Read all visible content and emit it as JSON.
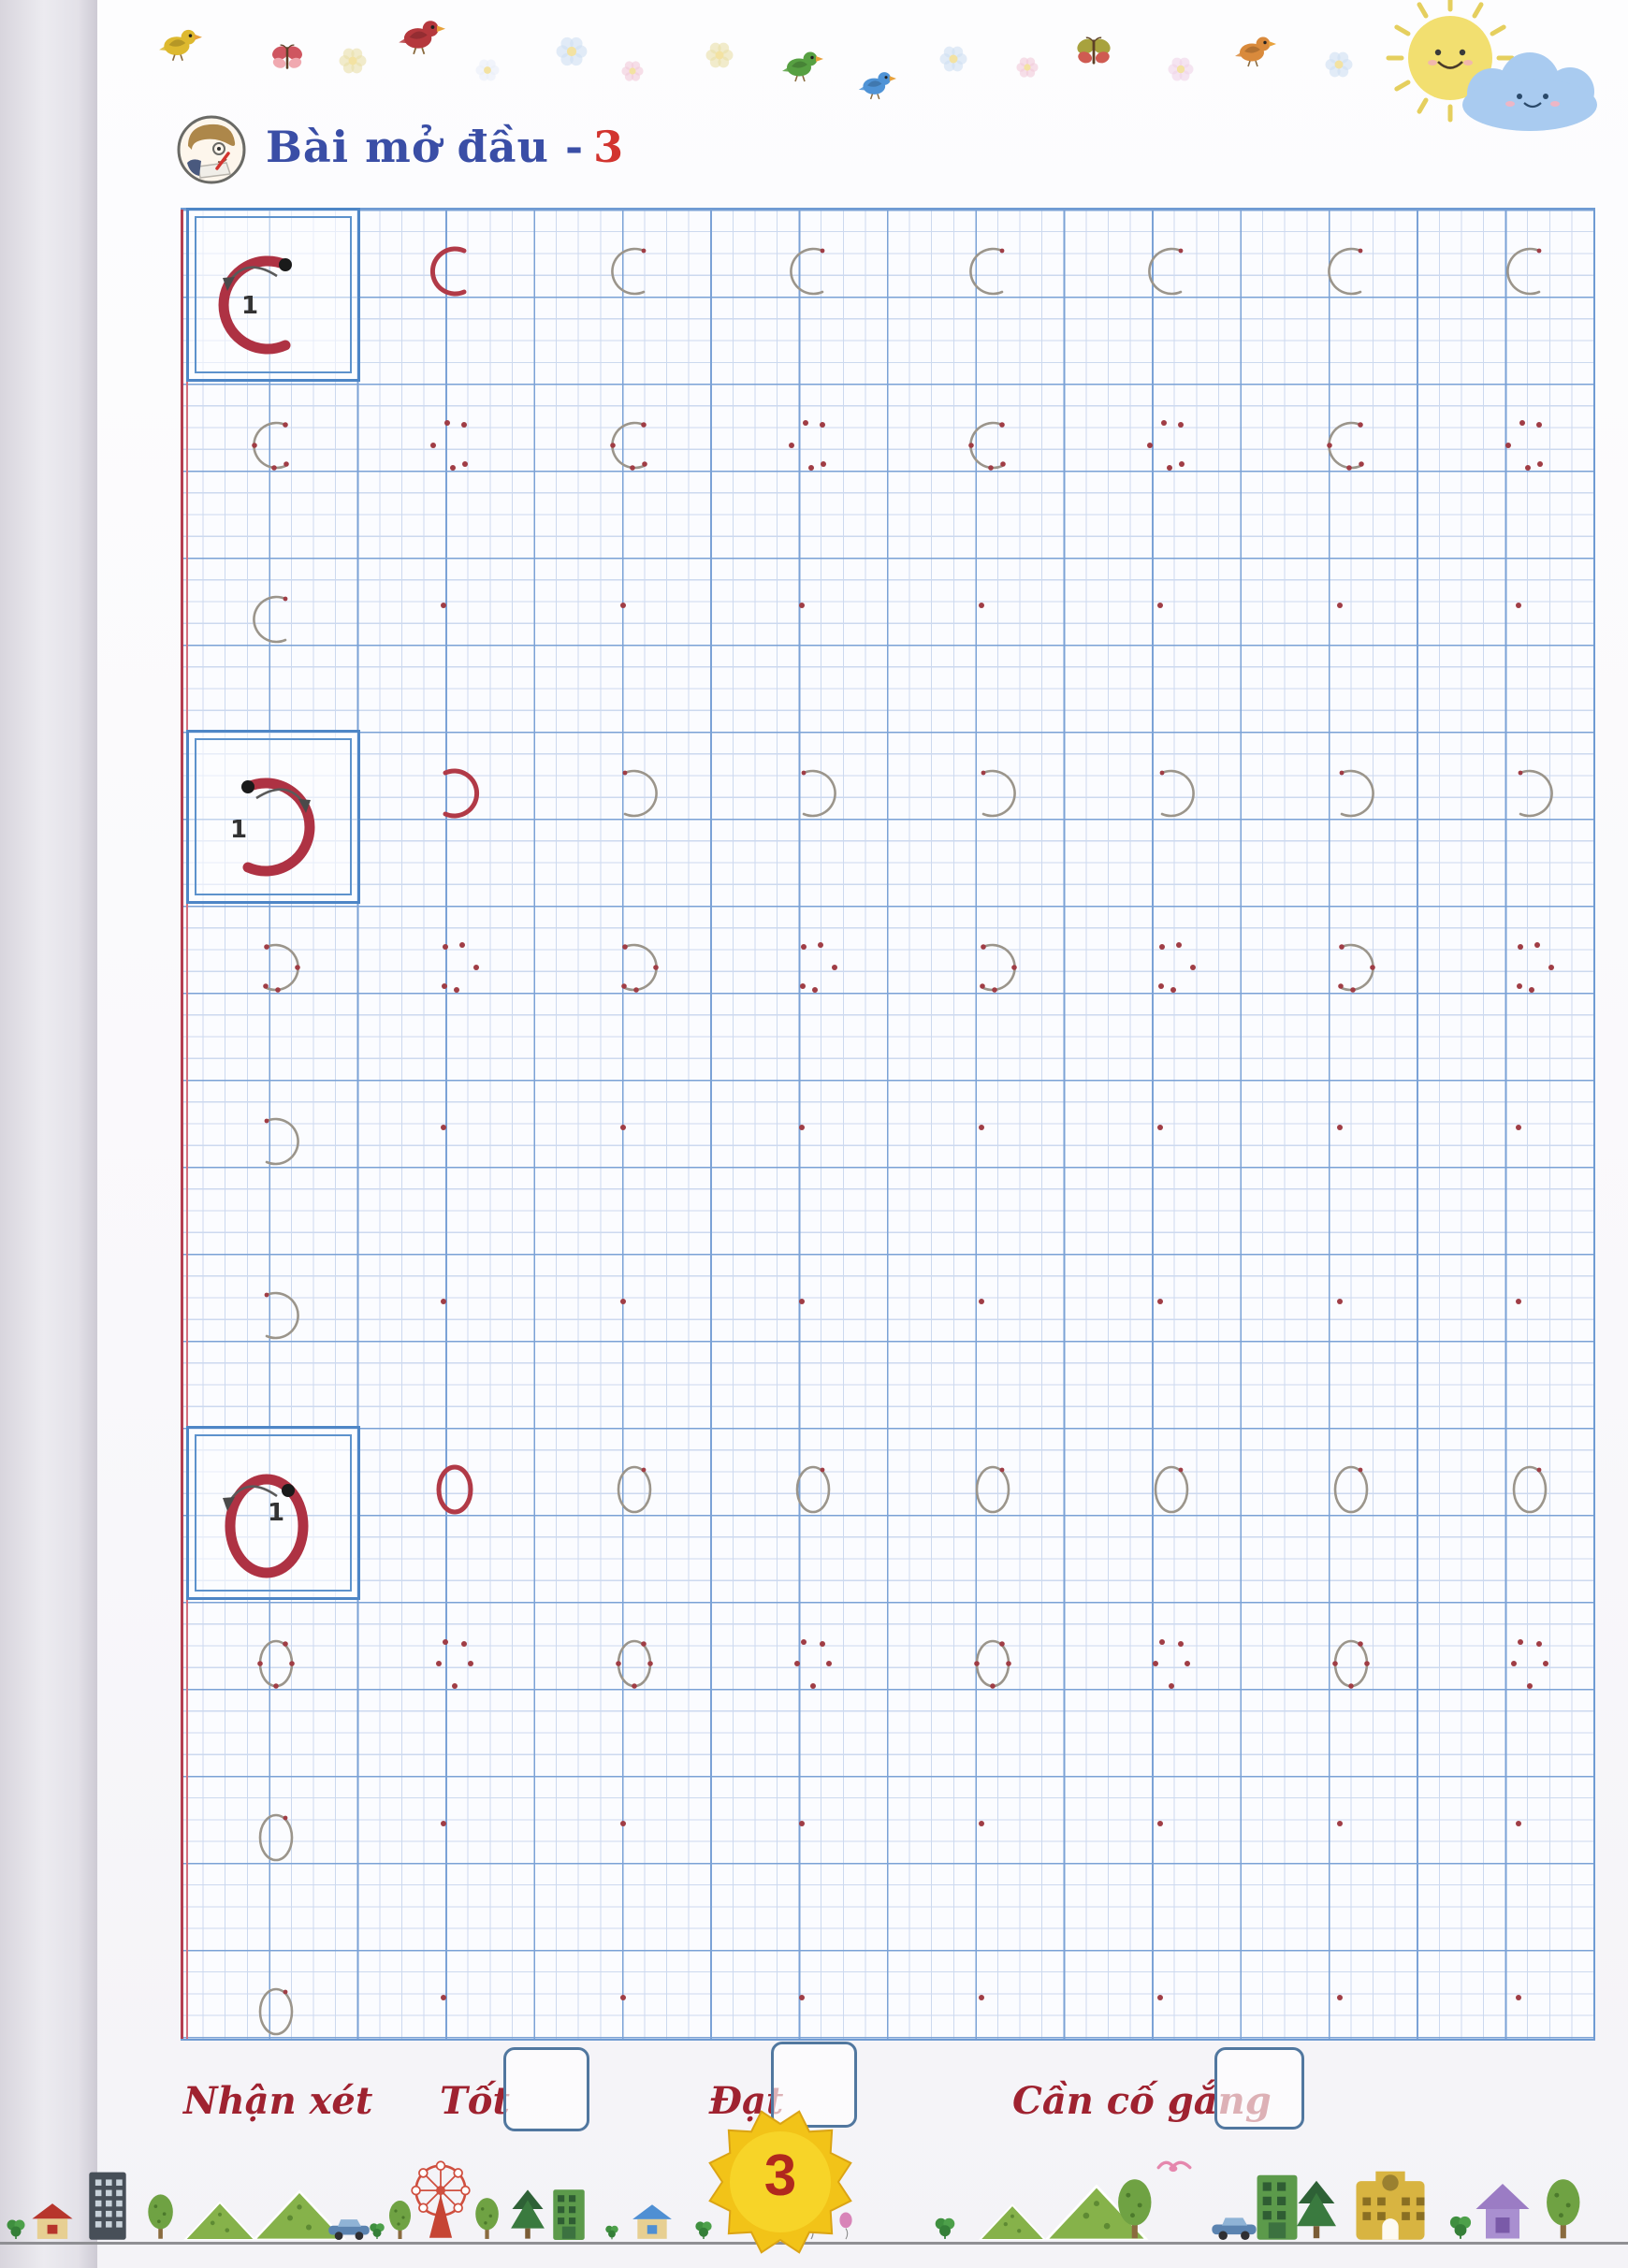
{
  "header": {
    "lesson_title": "Bài mở đầu -",
    "lesson_number": "3"
  },
  "practice": {
    "stroke_number_label": "1",
    "rows": [
      {
        "glyph": "C",
        "kind": "demo",
        "cells": [
          "red",
          "gray",
          "gray",
          "gray",
          "gray",
          "gray",
          "gray"
        ]
      },
      {
        "glyph": "C",
        "kind": "practice",
        "cells": [
          "trace",
          "cluster",
          "trace",
          "cluster",
          "trace",
          "cluster",
          "trace",
          "cluster"
        ]
      },
      {
        "glyph": "C",
        "kind": "practice",
        "cells": [
          "gray",
          "dot",
          "dot",
          "dot",
          "dot",
          "dot",
          "dot",
          "dot"
        ]
      },
      {
        "glyph": "Ɔ",
        "kind": "demo",
        "cells": [
          "red",
          "gray",
          "gray",
          "gray",
          "gray",
          "gray",
          "gray"
        ]
      },
      {
        "glyph": "Ɔ",
        "kind": "practice",
        "cells": [
          "trace",
          "cluster",
          "trace",
          "cluster",
          "trace",
          "cluster",
          "trace",
          "cluster"
        ]
      },
      {
        "glyph": "Ɔ",
        "kind": "practice",
        "cells": [
          "gray",
          "dot",
          "dot",
          "dot",
          "dot",
          "dot",
          "dot",
          "dot"
        ]
      },
      {
        "glyph": "Ɔ",
        "kind": "practice",
        "cells": [
          "gray",
          "dot",
          "dot",
          "dot",
          "dot",
          "dot",
          "dot",
          "dot"
        ]
      },
      {
        "glyph": "O",
        "kind": "demo",
        "cells": [
          "red",
          "gray",
          "gray",
          "gray",
          "gray",
          "gray",
          "gray"
        ]
      },
      {
        "glyph": "O",
        "kind": "practice",
        "cells": [
          "trace",
          "cluster",
          "trace",
          "cluster",
          "trace",
          "cluster",
          "trace",
          "cluster"
        ]
      },
      {
        "glyph": "O",
        "kind": "practice",
        "cells": [
          "gray",
          "dot",
          "dot",
          "dot",
          "dot",
          "dot",
          "dot",
          "dot"
        ]
      },
      {
        "glyph": "O",
        "kind": "practice",
        "cells": [
          "gray",
          "dot",
          "dot",
          "dot",
          "dot",
          "dot",
          "dot",
          "dot"
        ]
      }
    ]
  },
  "evaluation": {
    "label": "Nhận xét",
    "options": [
      "Tốt",
      "Đạt",
      "Cần cố gắng"
    ]
  },
  "footer": {
    "page_number": "3"
  },
  "decor": {
    "top_motifs": [
      "bird-yellow",
      "butterfly-red",
      "flower",
      "bird-red",
      "flower",
      "flower",
      "flower",
      "flower",
      "bird-green",
      "bird-blue",
      "flower",
      "flower",
      "butterfly-olive",
      "flower",
      "bird-orange",
      "flower"
    ],
    "sky": [
      "smiling-sun",
      "smiling-cloud"
    ],
    "footer_scene": [
      "clover",
      "house-red",
      "building-dark",
      "tree",
      "mountain",
      "mountain",
      "car",
      "clover",
      "tree",
      "ferris-wheel",
      "tree",
      "pine",
      "building-green",
      "clover",
      "house-blue",
      "clover",
      "balloon-blue",
      "balloon-pink",
      "clover",
      "mountain",
      "mountain",
      "bird-pink",
      "tree",
      "car",
      "building-green",
      "pine",
      "building-yellow",
      "clover",
      "house-purple",
      "tree"
    ]
  },
  "colors": {
    "title_blue": "#3a4ea6",
    "accent_red": "#b13a47",
    "grid_heavy_blue": "#7ba2d6",
    "grid_fine_blue": "#ccd9ef",
    "margin_red": "#b43e50",
    "eval_red": "#9f2230",
    "checkbox_blue": "#51779f",
    "sun_yellow": "#f2c318"
  }
}
